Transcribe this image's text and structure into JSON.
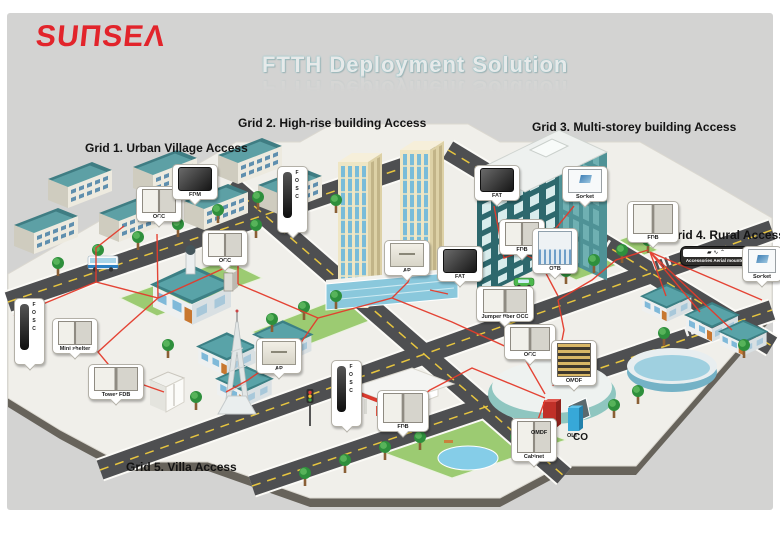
{
  "logo": {
    "text": "SUNSEA",
    "display": "SUΠSEΛ",
    "color": "#e2242b"
  },
  "title": {
    "text": "FTTH Deployment Solution"
  },
  "grids": [
    {
      "label": "Grid 1. Urban Village Access"
    },
    {
      "label": "Grid 2. High-rise building Access"
    },
    {
      "label": "Grid 3. Multi-storey building Access"
    },
    {
      "label": "Grid 4. Rural Access"
    },
    {
      "label": "Grid 5. Villa Access"
    }
  ],
  "callouts": {
    "occ1": {
      "label": "OCC"
    },
    "fdm": {
      "label": "FDM"
    },
    "fosc1": {
      "label": "FOSC"
    },
    "occ2": {
      "label": "OCC"
    },
    "ap1": {
      "label": "AP"
    },
    "fat1": {
      "label": "FAT"
    },
    "jumper": {
      "label": "Jumper fiber OCC"
    },
    "occ3": {
      "label": "OCC"
    },
    "fat2": {
      "label": "FAT"
    },
    "socket1": {
      "label": "Socket"
    },
    "fdb1": {
      "label": "FDB"
    },
    "otb": {
      "label": "OTB"
    },
    "fdb2": {
      "label": "FDB"
    },
    "aerial": {
      "label": "Accessories Aerial mounted",
      "icons": "▰ ∿ ⌃"
    },
    "socket2": {
      "label": "Socket"
    },
    "fosc2": {
      "label": "FOSC"
    },
    "mini": {
      "label": "Mini shelter"
    },
    "towerfdb": {
      "label": "Tower FDB"
    },
    "ap2": {
      "label": "AP"
    },
    "fosc3": {
      "label": "FOSC"
    },
    "fdb3": {
      "label": "FDB"
    },
    "omdf": {
      "label": "OMDF"
    },
    "cabinet": {
      "label": "Cabinet"
    }
  },
  "central_office": {
    "omdf": "OMDF",
    "olt": "OLT",
    "site": "CO"
  },
  "colors": {
    "panel": "#d3d3d2",
    "plate": "#f0efea",
    "road": "#4e4f51",
    "cable_red": "#e43b2c",
    "green": "#9ccb72",
    "roof_teal": "#3f7d83",
    "logo_red": "#e2242b",
    "title_glow": "#8fc7cc"
  }
}
